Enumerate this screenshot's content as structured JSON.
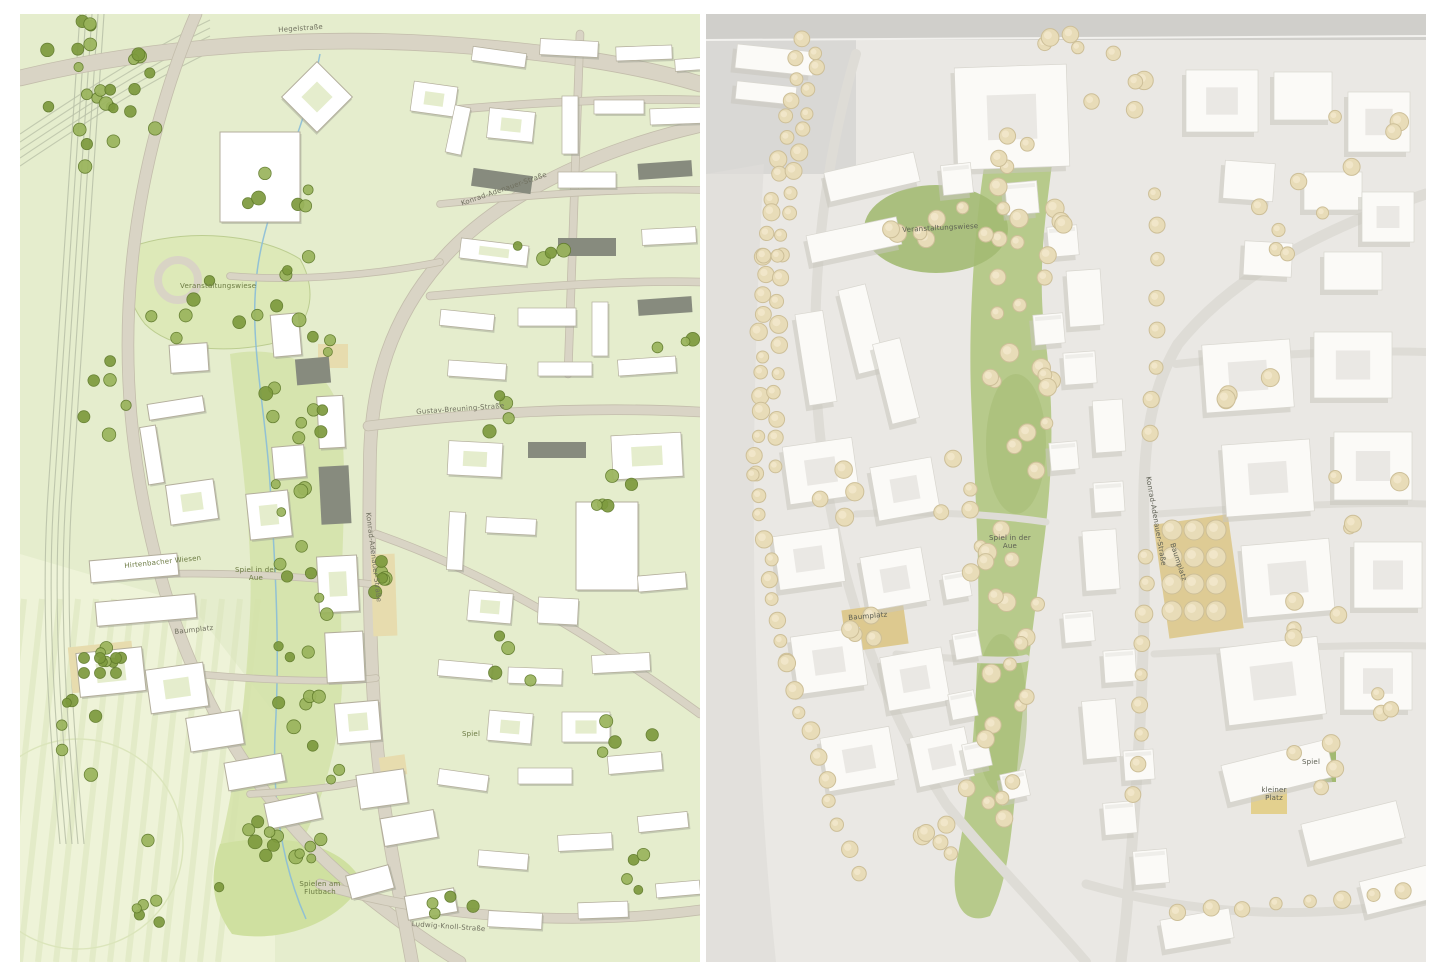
{
  "page": {
    "background": "#ffffff",
    "layout": "two-panel comparison of urban masterplan drawing (left) and architectural model photo (right)"
  },
  "palette": {
    "plan_background": "#e5edcd",
    "plan_field": "#eef3d8",
    "plan_field_stripe": "#dbe5bb",
    "plan_park": "#d4e2a8",
    "plan_meadow": "#dde9b8",
    "plan_road": "#d9d4c5",
    "plan_road_edge": "#c3bdab",
    "plan_building": "#ffffff",
    "plan_building_stroke": "#b3ae9c",
    "plan_building_gray": "#878b7e",
    "plan_tree": "#7d9a3d",
    "plan_tree_edge": "#5f7a2a",
    "plan_tree_light": "#9ab45c",
    "plan_rail": "#b9c1a8",
    "plan_sand": "#e7dcae",
    "plan_stream": "#8abcd8",
    "model_base": "#eae8e4",
    "model_table": "#d9d8d5",
    "model_road": "#dedcd6",
    "model_shadow": "#c9c6bd",
    "model_building": "#fbfaf7",
    "model_building_edge": "#d8d6cf",
    "model_green": "#b7ca8b",
    "model_green_dark": "#a3ba72",
    "model_tree": "#e8dcb8",
    "model_tree_edge": "#cdbf98",
    "model_sand": "#ddc98f",
    "label_gray": "#70705f",
    "label_green": "#6b7a42"
  },
  "left_panel": {
    "kind": "masterplan site drawing",
    "labels": {
      "hegelstrasse": "Hegelstraße",
      "konrad_adenauer_diagonal": "Konrad-Adenauer-Straße",
      "gustav_breuning": "Gustav-Breuning-Straße",
      "veranstaltungswiese": "Veranstaltungswiese",
      "hirtenbacher_wiesen": "Hirtenbacher Wiesen",
      "konrad_adenauer_vertical": "Konrad-Adenauer-Straße",
      "spiel_in_der_aue": "Spiel in der Aue",
      "baumplatz_west": "Baumplatz",
      "spiel": "Spiel",
      "spielen_am_flutbach": "Spielen am Flutbach",
      "ludwig_knoll": "Ludwig-Knoll-Straße"
    }
  },
  "right_panel": {
    "kind": "physical model photograph",
    "labels": {
      "veranstaltungswiese": "Veranstaltungswiese",
      "konrad_adenauer": "Konrad-Adenauer-Straße",
      "spiel_in_der_aue": "Spiel in der Aue",
      "baumplatz_east": "Baumplatz",
      "baumplatz_west": "Baumplatz",
      "spiel": "Spiel",
      "kleiner_platz": "kleiner Platz"
    }
  }
}
